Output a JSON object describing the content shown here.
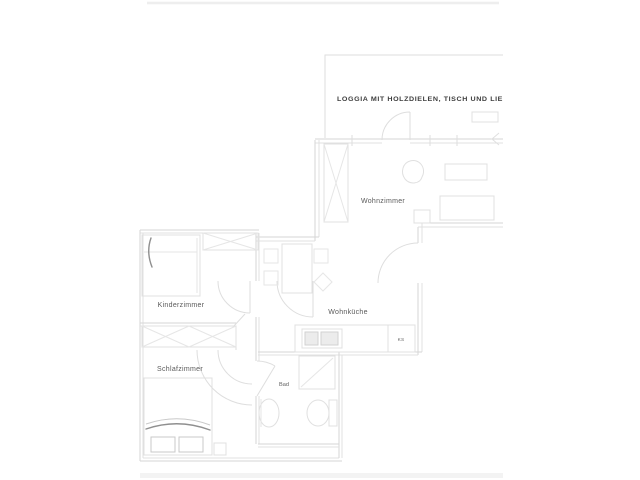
{
  "floorplan": {
    "type": "apartment-floor-plan",
    "labels": {
      "loggia": "LOGGIA MIT HOLZDIELEN, TISCH UND LIE",
      "wohnzimmer": "Wohnzimmer",
      "wohnkueche": "Wohnküche",
      "kinderzimmer": "Kinderzimmer",
      "schlafzimmer": "Schlafzimmer",
      "bad": "Bad",
      "ks": "KS"
    },
    "rooms": [
      {
        "id": "loggia",
        "label": "LOGGIA MIT HOLZDIELEN, TISCH UND LIE",
        "furniture": [
          "bench"
        ]
      },
      {
        "id": "wohnzimmer",
        "label": "Wohnzimmer",
        "furniture": [
          "wardrobe",
          "armchair",
          "table",
          "sofa",
          "side-table"
        ]
      },
      {
        "id": "wohnkueche",
        "label": "Wohnküche",
        "appliance": "KS",
        "furniture": [
          "dining-table",
          "chairs",
          "kitchen-counter",
          "sink",
          "fridge"
        ]
      },
      {
        "id": "kinderzimmer",
        "label": "Kinderzimmer",
        "furniture": [
          "bed",
          "wardrobe"
        ]
      },
      {
        "id": "schlafzimmer",
        "label": "Schlafzimmer",
        "furniture": [
          "wardrobe",
          "double-bed",
          "pillows",
          "nightstand"
        ]
      },
      {
        "id": "bad",
        "label": "Bad",
        "furniture": [
          "shower",
          "washbasin",
          "toilet"
        ]
      }
    ],
    "colors": {
      "background": "#ffffff",
      "wall_line": "#d6d6d6",
      "furniture_line": "#e0e0e0",
      "accent_dark_line": "#8f8f8f",
      "label_text": "#5a5a5a",
      "loggia_text": "#3d3d3d",
      "border_band": "#f3f3f3"
    }
  }
}
